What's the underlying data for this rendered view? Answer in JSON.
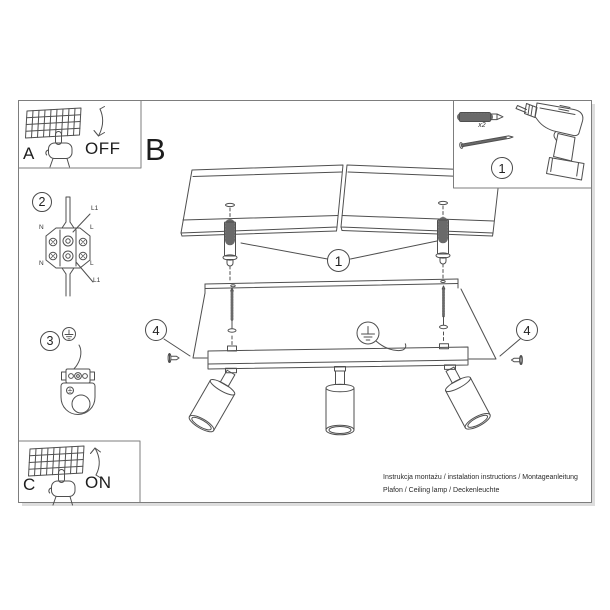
{
  "colors": {
    "border": "#7d7d7d",
    "line": "#4f4f4f",
    "shadow": "#d4d4d4"
  },
  "sections": {
    "a": {
      "label": "A",
      "state": "OFF"
    },
    "b": {
      "label": "B"
    },
    "c": {
      "label": "C",
      "state": "ON"
    },
    "step2": {
      "number": "2",
      "terminal_labels": {
        "l1_top": "L1",
        "n_top": "N",
        "l_top": "L",
        "n_bottom": "N",
        "l_bottom": "L",
        "l1_bottom": "L1"
      }
    },
    "step3": {
      "number": "3"
    },
    "parts_box": {
      "number": "1",
      "dowel_quantity": "x2"
    }
  },
  "callouts": {
    "plug_screw": "1",
    "side_screw_left": "4",
    "side_screw_right": "4"
  },
  "footer": {
    "line1": "Instrukcja montażu / instalation instructions / Montageanleitung",
    "line2": "Plafon / Ceiling lamp / Deckenleuchte"
  }
}
